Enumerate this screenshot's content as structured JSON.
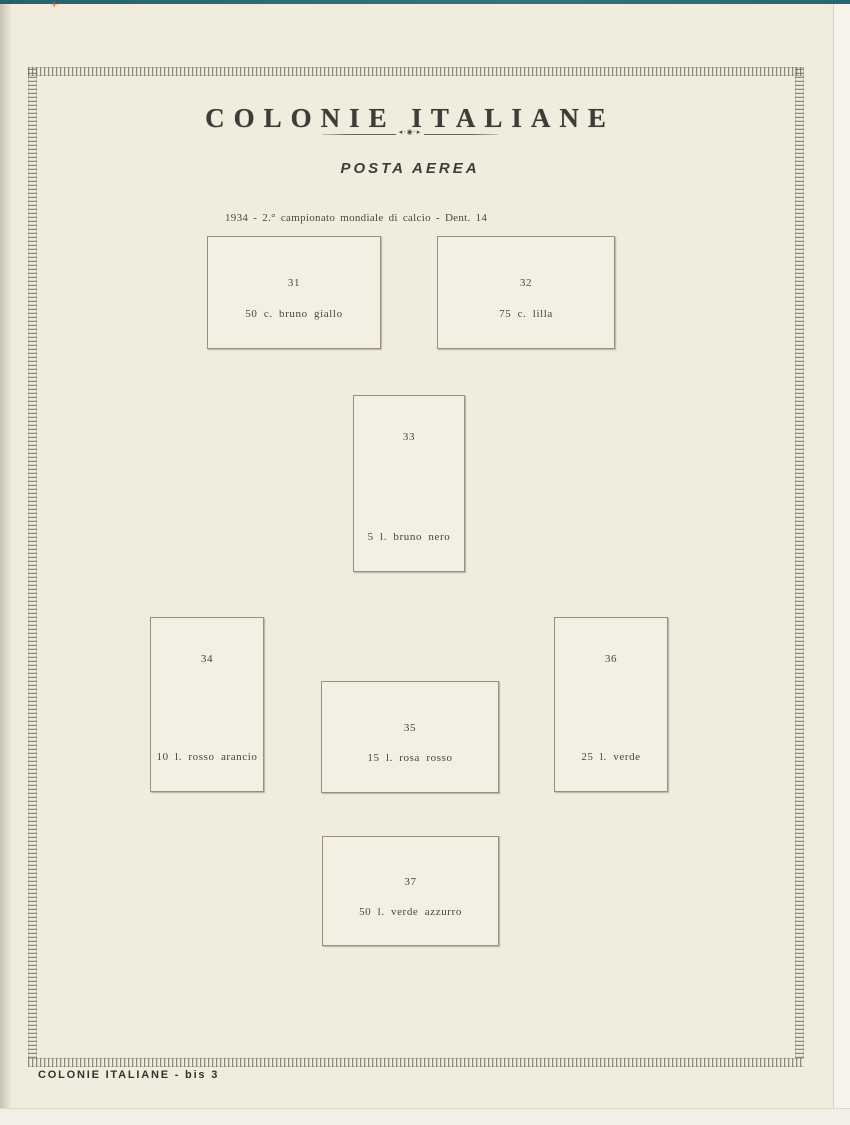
{
  "page": {
    "header_title": "COLONIE ITALIANE",
    "section_title": "POSTA AEREA",
    "series_caption": "1934 - 2.° campionato mondiale di calcio - Dent. 14",
    "footer_label": "COLONIE ITALIANE - bis 3"
  },
  "icons": {
    "divider_ornament": "◂·◉·▸",
    "registration_cross": "+"
  },
  "stamps": [
    {
      "number": "31",
      "label": "50 c. bruno giallo"
    },
    {
      "number": "32",
      "label": "75 c. lilla"
    },
    {
      "number": "33",
      "label": "5 l. bruno nero"
    },
    {
      "number": "34",
      "label": "10 l. rosso arancio"
    },
    {
      "number": "35",
      "label": "15 l. rosa rosso"
    },
    {
      "number": "36",
      "label": "25 l. verde"
    },
    {
      "number": "37",
      "label": "50 l. verde azzurro"
    }
  ],
  "colors": {
    "paper": "#f0edde",
    "box_fill": "#f3f0e3",
    "frame_tick": "#635f53",
    "scan_edge_teal": "#2e6b74",
    "text": "#48443a"
  }
}
